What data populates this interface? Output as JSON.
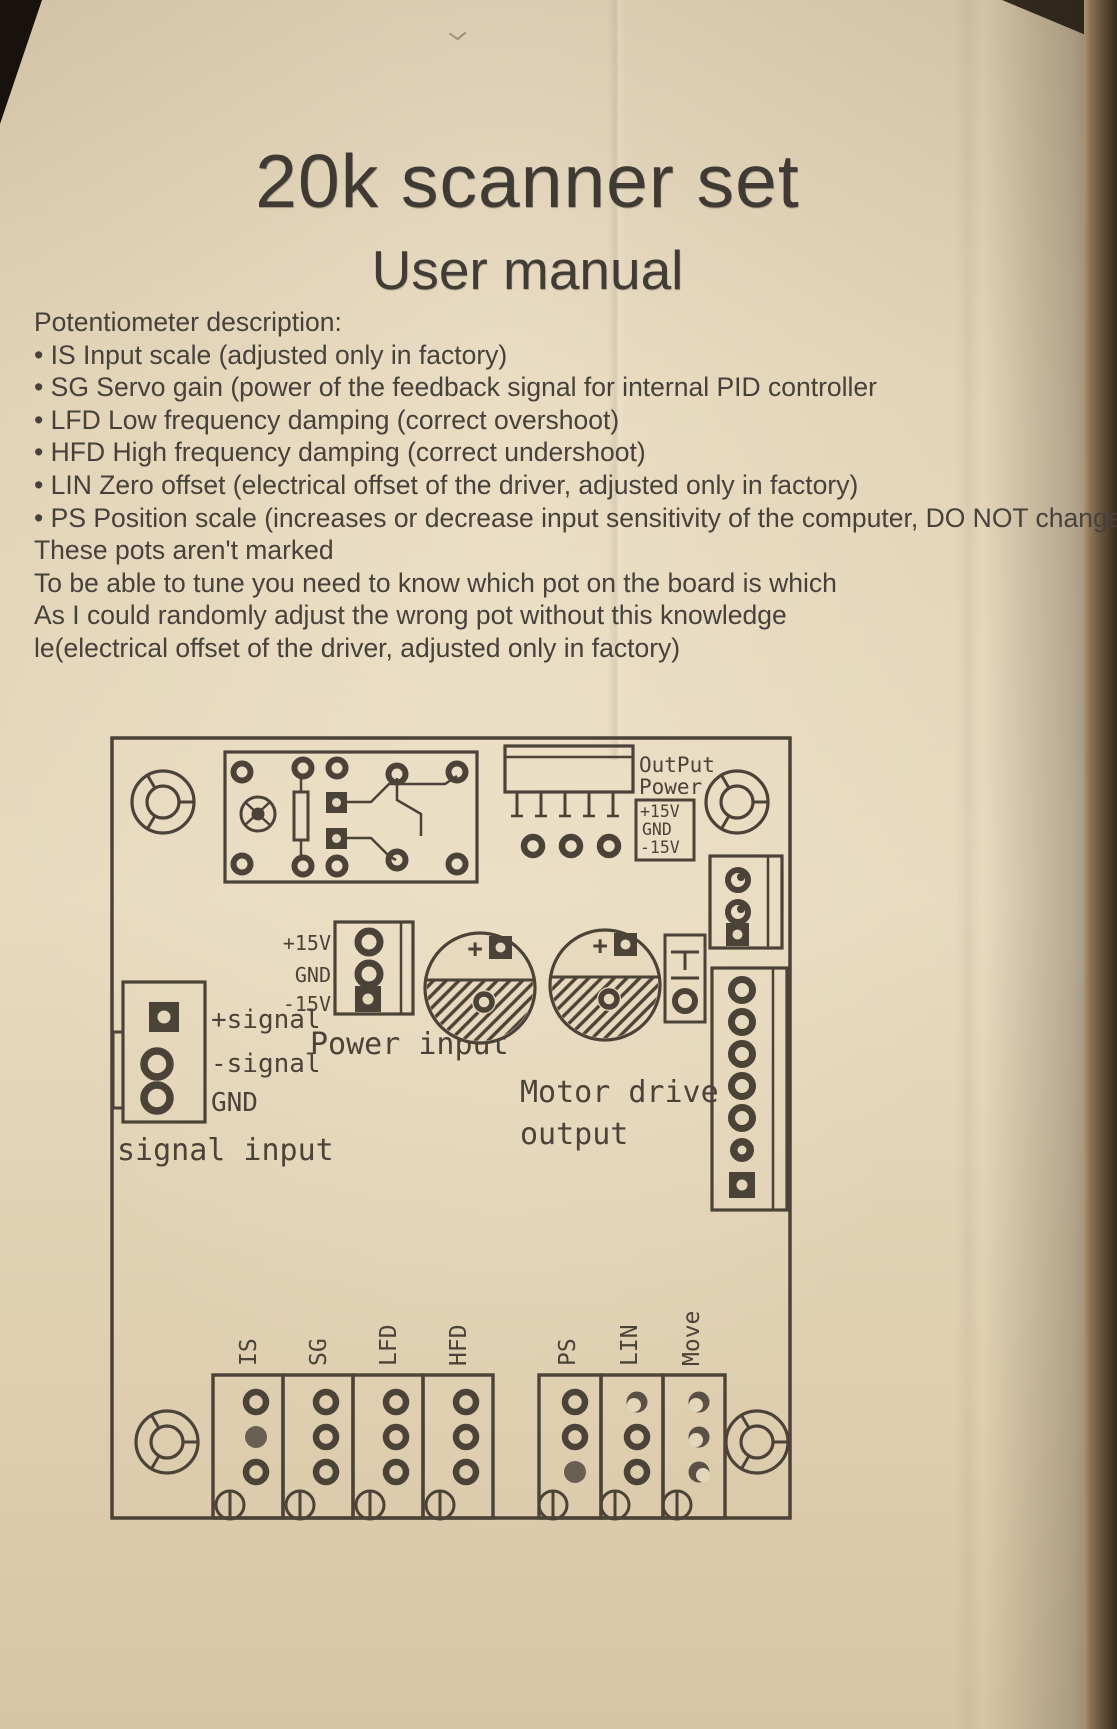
{
  "page": {
    "title": "20k scanner set",
    "subtitle": "User manual"
  },
  "description": {
    "heading": "Potentiometer description:",
    "lines": [
      "• IS Input scale (adjusted only in factory)",
      "• SG Servo gain (power of the feedback signal for internal PID controller",
      "• LFD Low frequency damping (correct overshoot)",
      "• HFD High frequency damping (correct undershoot)",
      "• LIN Zero offset (electrical offset of the driver, adjusted only in factory)",
      "• PS Position scale (increases or decrease input sensitivity of the computer, DO NOT change it)",
      "These pots aren't marked",
      "To be able to tune you need to know which pot on the board is which",
      "As I could randomly adjust the wrong pot without this knowledge",
      "le(electrical offset of the driver, adjusted only in factory)"
    ]
  },
  "diagram": {
    "output_power": {
      "line1": "OutPut",
      "line2": "Power",
      "pins": [
        "+15V",
        "GND",
        "-15V"
      ]
    },
    "power_input": {
      "label": "Power input",
      "pins": [
        "+15V",
        "GND",
        "-15V"
      ]
    },
    "signal_input": {
      "label": "signal input",
      "pins": [
        "+signal",
        "-signal",
        "GND"
      ]
    },
    "motor_output": {
      "line1": "Motor drive",
      "line2": "output"
    },
    "capacitor_polarity": "+",
    "pot_labels_left": [
      "IS",
      "SG",
      "LFD",
      "HFD"
    ],
    "pot_labels_right": [
      "PS",
      "LIN",
      "Move"
    ]
  },
  "colors": {
    "paper": "#e3d5b8",
    "ink": "#4c4338",
    "text_ink": "#46413a"
  }
}
